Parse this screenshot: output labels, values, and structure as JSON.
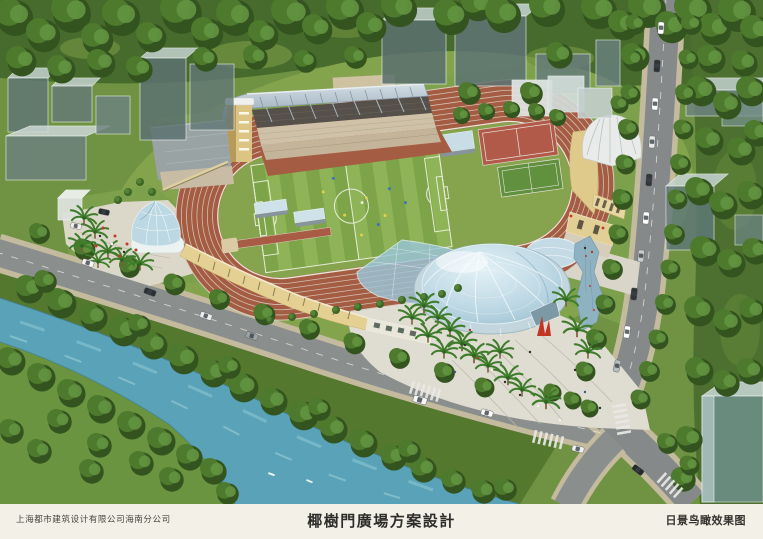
{
  "footer": {
    "company": "上海都市建筑设计有限公司海南分公司",
    "title": "椰樹門廣場方案設計",
    "view_label": "日景鸟瞰效果图"
  },
  "colors": {
    "paper": "#f3f0e7",
    "track_terracotta": "#a45c43",
    "field_green": "#85a44d",
    "forest_green": "#476b2c",
    "river_blue": "#59a2b8",
    "dome_glass": "#bdd8e4",
    "grandstand_roof": "#a9bac6",
    "wall_yellow": "#e3d092",
    "road_gray": "#8a8e8c",
    "plaza_paving": "#dfdcd1",
    "sculpture_red": "#c23524"
  }
}
